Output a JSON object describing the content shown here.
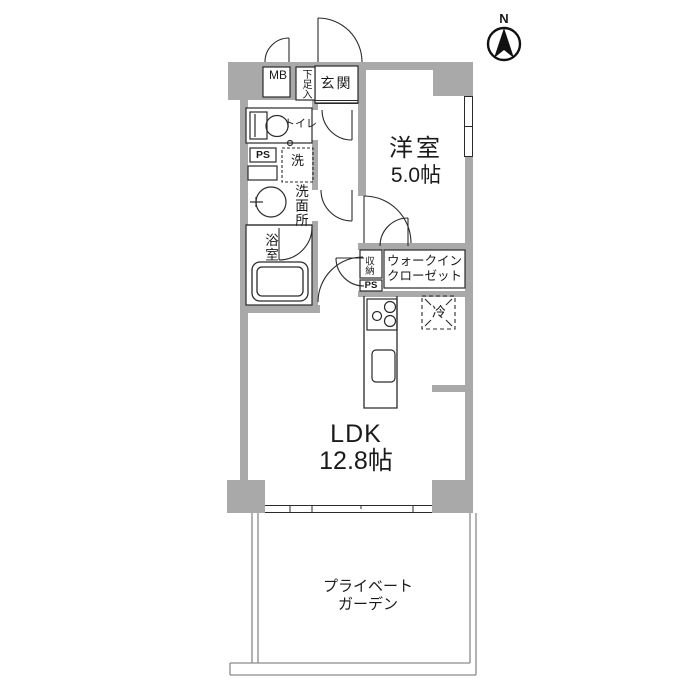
{
  "floor_plan": {
    "compass": {
      "north_label": "N"
    },
    "entrance_area": {
      "meter_box_label": "MB",
      "shoe_cabinet_label": "下足入",
      "entrance_label": "玄関"
    },
    "sanitary": {
      "toilet_label": "トイレ",
      "pipe_space_label": "PS",
      "washing_machine_label": "洗",
      "washroom_label": "洗面所",
      "bathroom_label": "浴室"
    },
    "western_room": {
      "name": "洋室",
      "size": "5.0帖"
    },
    "storage": {
      "closet_label": "収納",
      "walk_in_closet_line1": "ウォークイン",
      "walk_in_closet_line2": "クローゼット",
      "pipe_space_label": "PS"
    },
    "kitchen": {
      "refrigerator_label": "冷"
    },
    "ldk": {
      "name": "LDK",
      "size": "12.8帖"
    },
    "garden": {
      "line1": "プライベート",
      "line2": "ガーデン"
    },
    "colors": {
      "wall": "#a9a9a9",
      "line": "#2a2a2a",
      "thin_line": "#8a8a8a",
      "background": "#ffffff"
    }
  }
}
